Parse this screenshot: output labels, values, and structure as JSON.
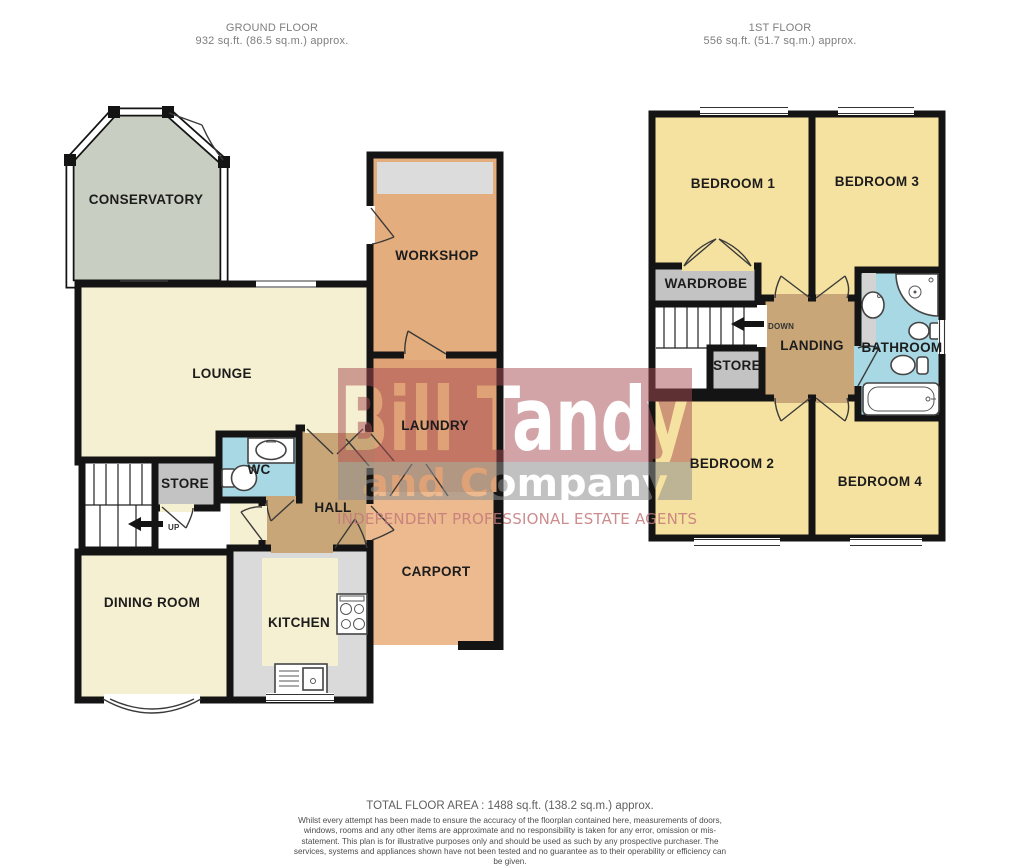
{
  "ground_floor": {
    "header_title": "GROUND FLOOR",
    "header_area": "932 sq.ft. (86.5 sq.m.) approx.",
    "rooms": {
      "conservatory": "CONSERVATORY",
      "lounge": "LOUNGE",
      "workshop": "WORKSHOP",
      "laundry": "LAUNDRY",
      "store": "STORE",
      "wc": "WC",
      "hall": "HALL",
      "dining_room": "DINING ROOM",
      "kitchen": "KITCHEN",
      "carport": "CARPORT",
      "stairs_direction": "UP"
    }
  },
  "first_floor": {
    "header_title": "1ST FLOOR",
    "header_area": "556 sq.ft. (51.7 sq.m.) approx.",
    "rooms": {
      "bedroom1": "BEDROOM 1",
      "bedroom3": "BEDROOM 3",
      "wardrobe": "WARDROBE",
      "store": "STORE",
      "landing": "LANDING",
      "bathroom": "BATHROOM",
      "bedroom2": "BEDROOM 2",
      "bedroom4": "BEDROOM 4",
      "stairs_direction": "DOWN"
    }
  },
  "watermark": {
    "line1": "Bill Tandy",
    "line2": "and Company",
    "tagline": "INDEPENDENT PROFESSIONAL ESTATE AGENTS"
  },
  "footer": {
    "total_area": "TOTAL FLOOR AREA : 1488 sq.ft. (138.2 sq.m.) approx.",
    "disclaimer": "Whilst every attempt has been made to ensure the accuracy of the floorplan contained here, measurements of doors, windows, rooms and any other items are approximate and no responsibility is taken for any error, omission or mis-statement. This plan is for illustrative purposes only and should be used as such by any prospective purchaser. The services, systems and appliances shown have not been tested and no guarantee as to their operability or efficiency can be given.",
    "credit": "Made with Metropix ©2026"
  },
  "palette": {
    "wall": "#141414",
    "cream_room": "#f6f0d2",
    "yellow_room": "#f6e2a0",
    "orange_room": "#e4ad7e",
    "laundry_orange": "#dfa276",
    "carport_orange": "#ecba8e",
    "tan_hall": "#c9a678",
    "blue_bath": "#a7d8e4",
    "gray_store": "#c3c3c3",
    "sage_conservatory": "#c8cec1",
    "counter_gray": "#dadada",
    "garage_gray": "#dcdcdc",
    "watermark_red": "#a84c52",
    "watermark_gray": "#8f8f8f"
  }
}
